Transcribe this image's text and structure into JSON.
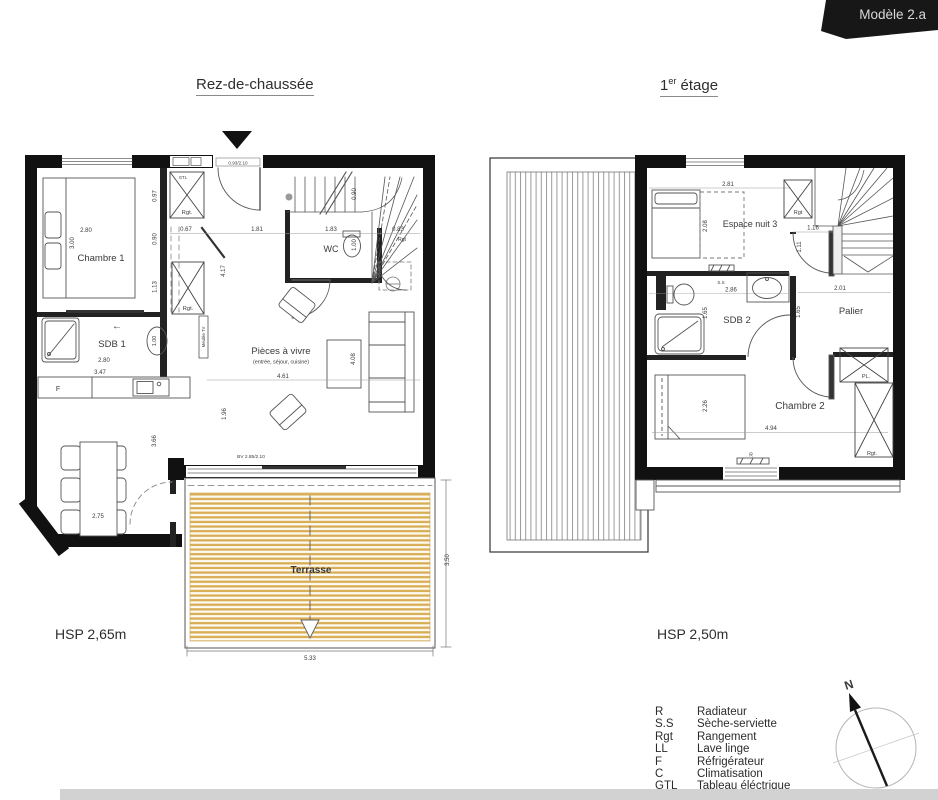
{
  "banner": {
    "model": "Modèle 2.a"
  },
  "floors": {
    "ground": {
      "title": "Rez-de-chaussée",
      "hsp": "HSP 2,65m",
      "rooms": {
        "chambre1": "Chambre 1",
        "sdb1": "SDB 1",
        "wc": "WC",
        "living": "Pièces à vivre",
        "living_sub": "(entrée, séjour, cuisine)",
        "terrasse": "Terrasse"
      },
      "annotations": {
        "entry_door": "0.93/2.10",
        "bay_window": "BV 2.85/2.10",
        "rgt_entry": "Rgt.",
        "rgt_hall": "Rgt.",
        "rgt_stairs": "Rgt",
        "gtl": "GTL",
        "fridge": "F",
        "tv": "Meuble TV",
        "slide_arrow": "←"
      },
      "dims": {
        "bed_w": "2.80",
        "bed_h": "3.00",
        "v097": "0.97",
        "v090": "0.90",
        "v113": "1.13",
        "h067": "0.67",
        "h181": "1.81",
        "h183": "1.83",
        "h083": "0.83",
        "stairs_v090": "0.90",
        "wc_v100": "1.00",
        "hall_v417": "4.17",
        "sdb1_w": "2.80",
        "sdb1_sink": "1.00",
        "kitchen_w": "3.47",
        "living_w": "4.61",
        "living_h": "4.08",
        "living_v196": "1.96",
        "dining_h": "3.66",
        "dining_w": "2.75",
        "terrasse_w": "5.33",
        "terrasse_h": "3.50"
      }
    },
    "first": {
      "title_num": "1",
      "title_sup": "er",
      "title_rest": " étage",
      "hsp": "HSP 2,50m",
      "rooms": {
        "espace": "Espace nuit 3",
        "sdb2": "SDB 2",
        "palier": "Palier",
        "chambre2": "Chambre 2"
      },
      "annotations": {
        "rgt_top": "Rgt",
        "ss": "S.S",
        "pl": "PL.",
        "rgt_bottom": "Rgt.",
        "r": "R"
      },
      "dims": {
        "top_w": "2.81",
        "bed_h": "2.08",
        "stairs_w": "1.16",
        "v111": "1.11",
        "sdb2_w": "2.86",
        "palier_w": "2.01",
        "sdb2_h": "1.65",
        "palier_h": "1.65",
        "bed2_h": "2.26",
        "chambre2_w": "4.94"
      }
    }
  },
  "legend": {
    "items": [
      {
        "code": "R",
        "label": "Radiateur"
      },
      {
        "code": "S.S",
        "label": "Sèche-serviette"
      },
      {
        "code": "Rgt",
        "label": "Rangement"
      },
      {
        "code": "LL",
        "label": "Lave linge"
      },
      {
        "code": "F",
        "label": "Réfrigérateur"
      },
      {
        "code": "C",
        "label": "Climatisation"
      },
      {
        "code": "GTL",
        "label": "Tableau éléctrique"
      }
    ]
  },
  "compass": {
    "north": "N"
  }
}
